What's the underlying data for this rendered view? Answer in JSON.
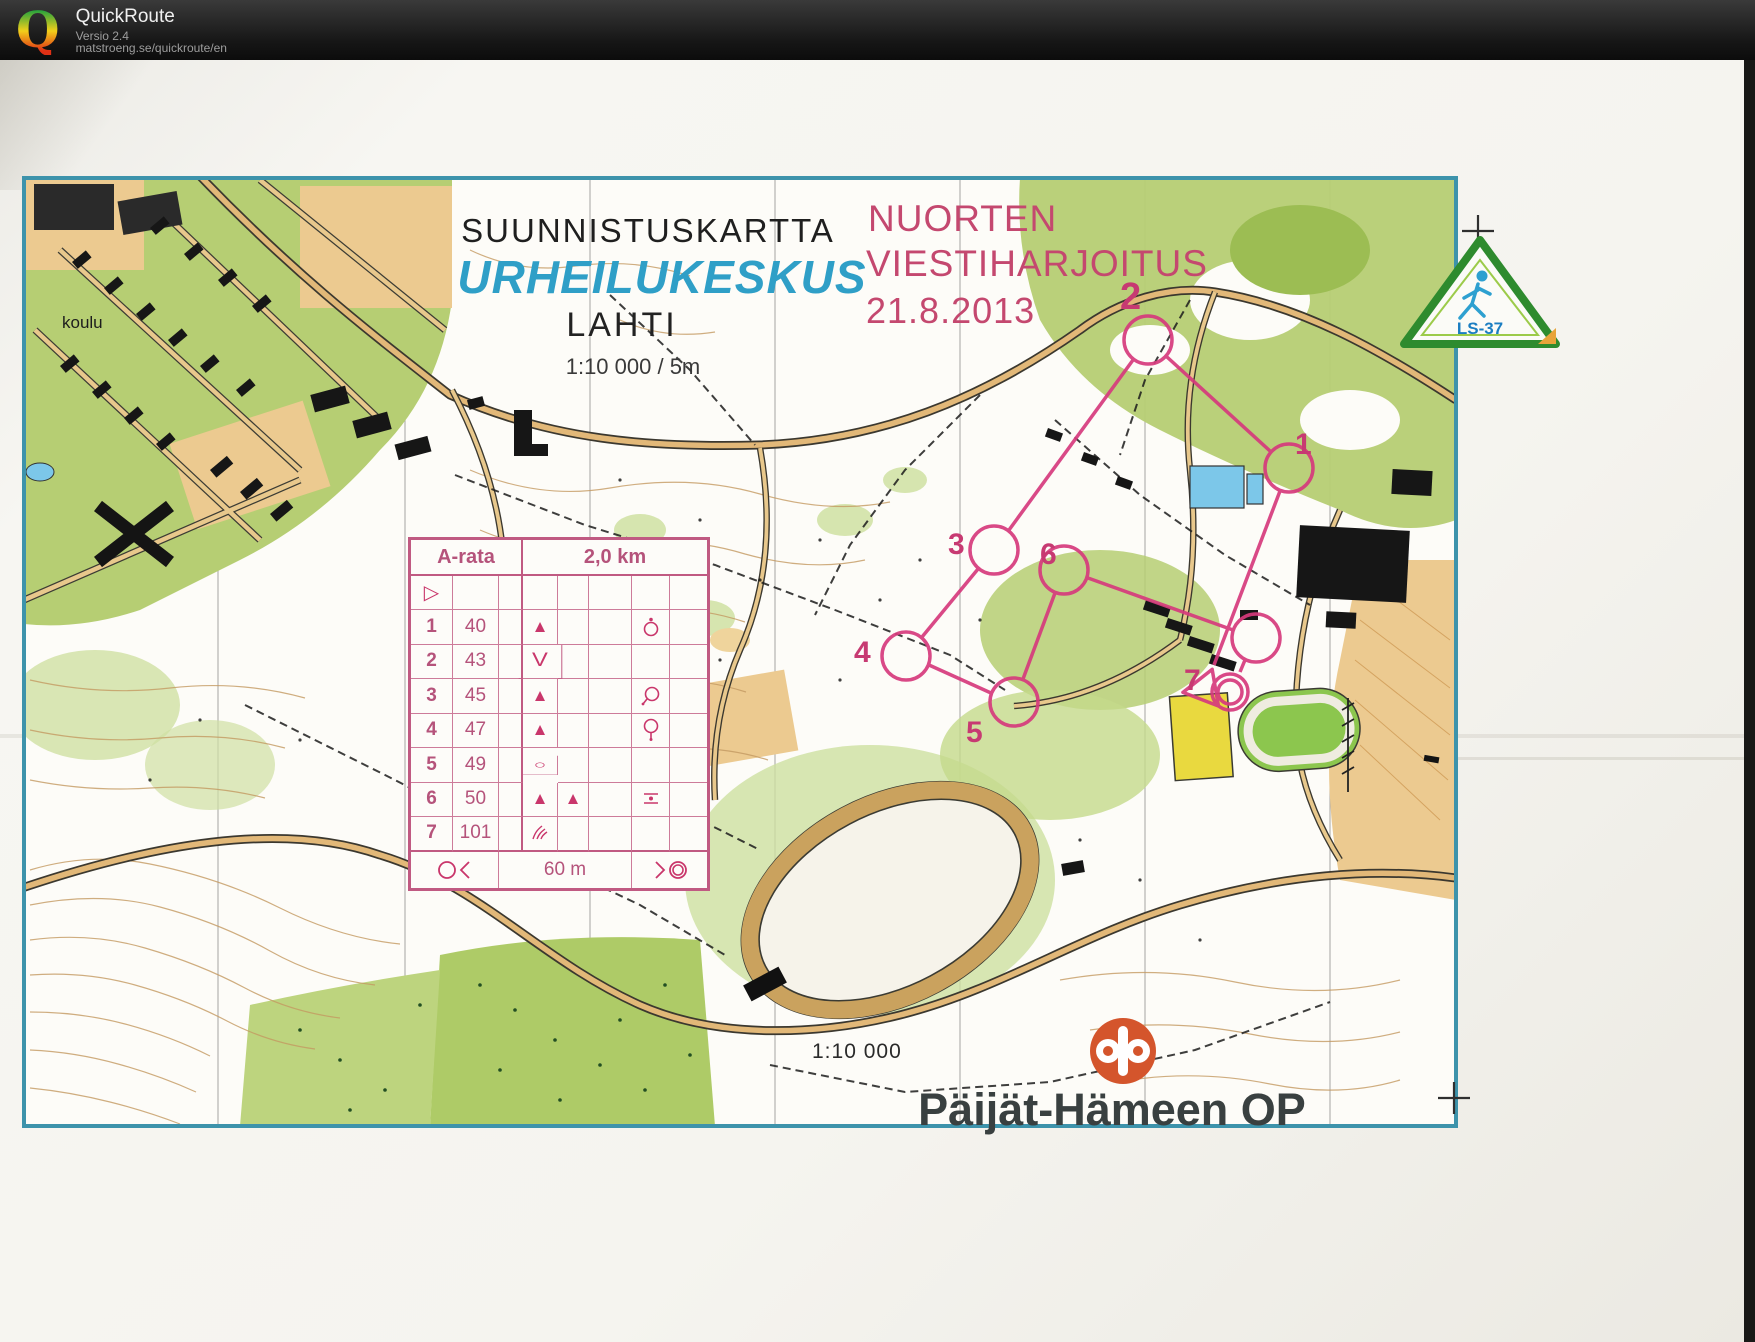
{
  "header": {
    "app_name": "QuickRoute",
    "version": "Versio 2.4",
    "url": "matstroeng.se/quickroute/en",
    "logo_letter": "Q"
  },
  "titles": {
    "map_kind": "SUUNNISTUSKARTTA",
    "map_name": "URHEILUKESKUS",
    "city": "LAHTI",
    "scale_line": "1:10 000   /   5m"
  },
  "event": {
    "line1": "NUORTEN",
    "line2": "VIESTIHARJOITUS",
    "date": "21.8.2013"
  },
  "map_labels": {
    "school": "koulu",
    "bottom_scale": "1:10 000"
  },
  "control_table": {
    "course_name": "A-rata",
    "course_length": "2,0 km",
    "climb_text": "60 m",
    "start_symbol": "▷",
    "rows": [
      {
        "num": "1",
        "code": "40",
        "sym_d": "▲",
        "sym_e": "",
        "extra_icon": "boulder-marked-side"
      },
      {
        "num": "2",
        "code": "43",
        "sym_d": "V",
        "sym_e": "",
        "extra_icon": ""
      },
      {
        "num": "3",
        "code": "45",
        "sym_d": "▲",
        "sym_e": "",
        "extra_icon": "circle-tail"
      },
      {
        "num": "4",
        "code": "47",
        "sym_d": "▲",
        "sym_e": "",
        "extra_icon": "circle-stem"
      },
      {
        "num": "5",
        "code": "49",
        "sym_d": "○",
        "sym_e": "",
        "extra_icon": ""
      },
      {
        "num": "6",
        "code": "50",
        "sym_d": "▲",
        "sym_e": "▲",
        "extra_icon": "dot-between-lines"
      },
      {
        "num": "7",
        "code": "101",
        "sym_d": "",
        "sym_e": "",
        "extra_icon": "gully"
      }
    ]
  },
  "course": {
    "color": "#d63a7d",
    "numbers": [
      {
        "label": "1"
      },
      {
        "label": "2"
      },
      {
        "label": "3"
      },
      {
        "label": "4"
      },
      {
        "label": "5"
      },
      {
        "label": "6"
      },
      {
        "label": "7"
      }
    ]
  },
  "logos": {
    "ls37_text": "LS-37",
    "op_text": "Päijät-Hämeen OP"
  },
  "colors": {
    "frame_teal": "#3d93ab",
    "title_blue": "#2f9fc7",
    "event_pink": "#c4486f",
    "table_pink": "#c05a82",
    "course_pink": "#d63a7d",
    "op_orange": "#d4552c",
    "ls37_green": "#2e8b2e",
    "map_green": "#b6ce73",
    "map_tan": "#ecca90"
  }
}
